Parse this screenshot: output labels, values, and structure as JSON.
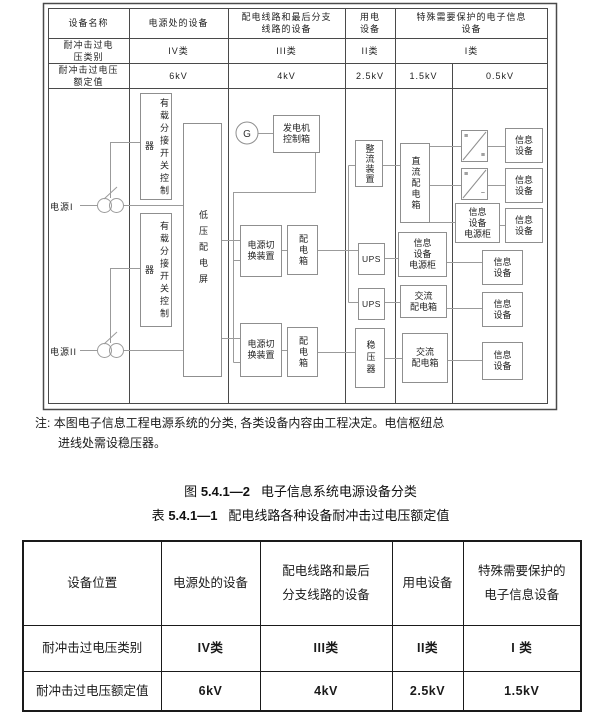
{
  "figure": {
    "header_table": {
      "col_headers": [
        "设备名称",
        "电源处的设备",
        "配电线路和最后分支\n线路的设备",
        "用电\n设备",
        "特殊需要保护的电子信息\n设备"
      ],
      "row_category": {
        "label": "耐冲击过电\n压类别",
        "values": [
          "IV类",
          "III类",
          "II类",
          "I类"
        ]
      },
      "row_rating": {
        "label": "耐冲击过电压\n额定值",
        "values": [
          "6kV",
          "4kV",
          "2.5kV",
          "1.5kV",
          "0.5kV"
        ]
      }
    },
    "diagram": {
      "source1": "电源I",
      "source2": "电源II",
      "gen_label": "G",
      "boxes": {
        "tap_controller": "有载分接开关控制器",
        "lv_panel": "低压配电屏",
        "gen_control": "发电机\n控制箱",
        "transfer": "电源切\n换装置",
        "dist_box": "配电箱",
        "rectifier": "整流装置",
        "ups": "UPS",
        "stabilizer": "稳压器",
        "dc_dist": "直流配电箱",
        "info_cabinet": "信息\n设备\n电源柜",
        "ac_dist": "交流\n配电箱",
        "info_device": "信息\n设备",
        "conv_dc_mark": "≡",
        "conv_ac_mark": "~"
      }
    },
    "note": {
      "prefix": "注:",
      "line1": "本图电子信息工程电源系统的分类, 各类设备内容由工程决定。电信枢纽总",
      "line2": "进线处需设稳压器。"
    }
  },
  "captions": {
    "figure": {
      "prefix": "图",
      "number": "5.4.1—2",
      "title": "电子信息系统电源设备分类"
    },
    "table": {
      "prefix": "表",
      "number": "5.4.1—1",
      "title": "配电线路各种设备耐冲击过电压额定值"
    }
  },
  "bottom_table": {
    "headers": [
      "设备位置",
      "电源处的设备",
      "配电线路和最后\n分支线路的设备",
      "用电设备",
      "特殊需要保护的\n电子信息设备"
    ],
    "rows": [
      {
        "label": "耐冲击过电压类别",
        "values": [
          "IV类",
          "III类",
          "II类",
          "I 类"
        ]
      },
      {
        "label": "耐冲击过电压额定值",
        "values": [
          "6kV",
          "4kV",
          "2.5kV",
          "1.5kV"
        ]
      }
    ]
  },
  "colors": {
    "grid": "#4a4a4a",
    "wire": "#9b9b9b",
    "ink": "#1a1a1a"
  }
}
